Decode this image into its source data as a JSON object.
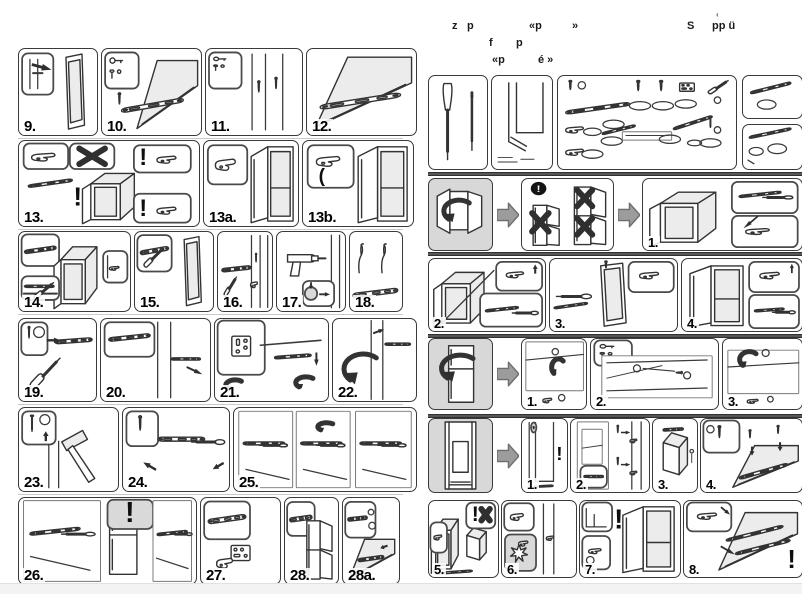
{
  "page": {
    "background": "#ffffff",
    "ink_color": "#333333",
    "shade_color": "#d8d8d8",
    "separator_color": "#3a3a3a",
    "footer_bar_color": "#f3f3f4"
  },
  "header": {
    "fragments": [
      {
        "text": "z"
      },
      {
        "text": "p"
      },
      {
        "text": "«p"
      },
      {
        "text": "»"
      },
      {
        "text": "‹"
      },
      {
        "text": "S"
      },
      {
        "text": "pp ü"
      },
      {
        "text": "f"
      },
      {
        "text": "p"
      },
      {
        "text": "«p"
      },
      {
        "text": "é »"
      }
    ]
  },
  "left_page": {
    "rows": [
      {
        "panels": [
          {
            "label": "9.",
            "art": "door-gap-check"
          },
          {
            "label": "10.",
            "art": "bottom-rail-mounting"
          },
          {
            "label": "11.",
            "art": "side-screws"
          },
          {
            "label": "12.",
            "art": "bottom-rail"
          }
        ]
      },
      {
        "panels": [
          {
            "label": "13.",
            "art": "hinge-warning"
          },
          {
            "label": "13a.",
            "art": "door-clip"
          },
          {
            "label": "13b.",
            "art": "door-clip-alt"
          }
        ]
      },
      {
        "panels": [
          {
            "label": "14.",
            "art": "rail-door-mount"
          },
          {
            "label": "15.",
            "art": "rail-door-panel"
          },
          {
            "label": "16.",
            "art": "bracket-slide"
          },
          {
            "label": "17.",
            "art": "drilling"
          },
          {
            "label": "18.",
            "art": "fixing-clips"
          }
        ]
      },
      {
        "panels": [
          {
            "label": "19.",
            "art": "screwdriver-rail"
          },
          {
            "label": "20.",
            "art": "slider-insert"
          },
          {
            "label": "21.",
            "art": "hinge-plate-adjust"
          },
          {
            "label": "22.",
            "art": "door-swing"
          }
        ]
      },
      {
        "panels": [
          {
            "label": "23.",
            "art": "hammer-nail"
          },
          {
            "label": "24.",
            "art": "rail-screwing"
          },
          {
            "label": "25.",
            "art": "screw-sequence"
          }
        ]
      },
      {
        "panels": [
          {
            "label": "26.",
            "art": "rail-adjust-check"
          },
          {
            "label": "27.",
            "art": "hinge-clip"
          },
          {
            "label": "28.",
            "art": "cabinet-doors"
          },
          {
            "label": "28a.",
            "art": "door-rail-detail"
          }
        ]
      }
    ]
  },
  "right_page": {
    "tools": {
      "panels": [
        {
          "art": "screwdriver-tool"
        },
        {
          "art": "niche-diagram"
        },
        {
          "art": "parts-overview"
        },
        {
          "art": "part-strip-a"
        },
        {
          "art": "part-strip-b"
        }
      ]
    },
    "rows": [
      {
        "cells": [
          {
            "kind": "panel",
            "gray": true,
            "art": "door-reversal"
          },
          {
            "kind": "arrow"
          },
          {
            "kind": "panel",
            "art": "cabinet-warning"
          },
          {
            "kind": "arrow"
          },
          {
            "kind": "panel",
            "label": "1.",
            "art": "fridge-hinge-detail"
          }
        ]
      },
      {
        "cells": [
          {
            "kind": "panel",
            "label": "2.",
            "art": "door-unhinge"
          },
          {
            "kind": "panel",
            "label": "3.",
            "art": "door-lift-off"
          },
          {
            "kind": "panel",
            "label": "4.",
            "art": "hinge-remount"
          }
        ]
      },
      {
        "cells": [
          {
            "kind": "panel",
            "gray": true,
            "art": "door-swap"
          },
          {
            "kind": "arrow"
          },
          {
            "kind": "panel",
            "label": "1.",
            "art": "pin-remove"
          },
          {
            "kind": "panel",
            "label": "2.",
            "art": "pin-transfer"
          },
          {
            "kind": "panel",
            "label": "3.",
            "art": "pin-insert"
          }
        ]
      },
      {
        "cells": [
          {
            "kind": "panel",
            "gray": true,
            "art": "niche-fit"
          },
          {
            "kind": "arrow"
          },
          {
            "kind": "panel",
            "label": "1.",
            "art": "niche-check"
          },
          {
            "kind": "panel",
            "label": "2.",
            "art": "panel-mount"
          },
          {
            "kind": "panel",
            "label": "3.",
            "art": "rail-top"
          },
          {
            "kind": "panel",
            "label": "4.",
            "art": "screw-top"
          }
        ]
      },
      {
        "cells": [
          {
            "kind": "panel",
            "label": "5.",
            "art": "slide-in"
          },
          {
            "kind": "panel",
            "label": "6.",
            "art": "clip-fix"
          },
          {
            "kind": "panel",
            "label": "7.",
            "art": "door-open-fix"
          },
          {
            "kind": "panel",
            "label": "8.",
            "art": "rail-final"
          }
        ]
      }
    ]
  }
}
